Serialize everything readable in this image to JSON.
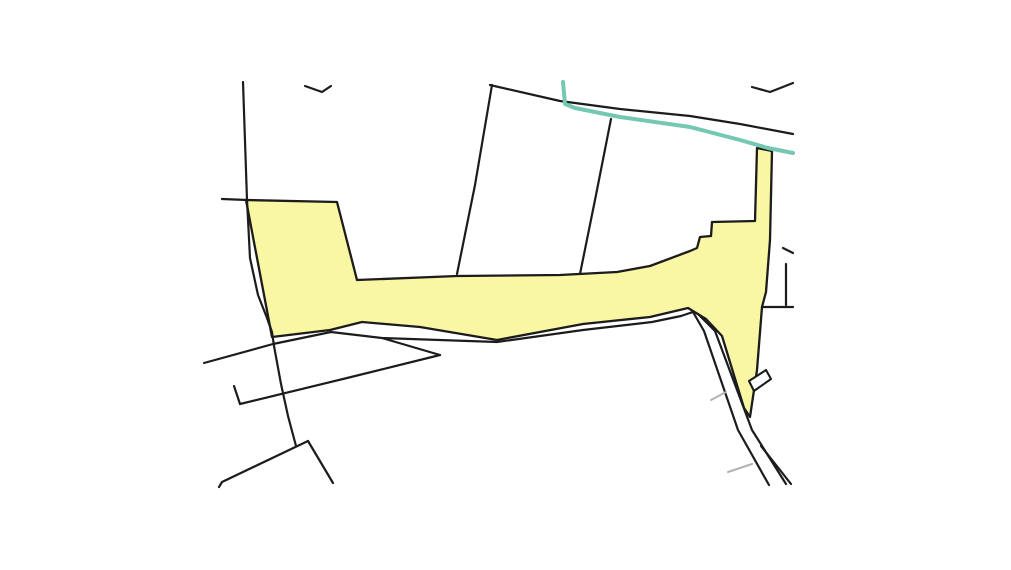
{
  "canvas": {
    "width": 1011,
    "height": 570,
    "background": "#ffffff"
  },
  "map": {
    "colors": {
      "parcel_fill": "#f9f7a3",
      "parcel_stroke": "#1c1c1c",
      "boundary": "#1c1c1c",
      "stream": "#74c8b2",
      "building_fill": "#ffffff",
      "tick": "#b3b3b3"
    },
    "stroke_widths": {
      "boundary": 2.2,
      "parcel": 2.3,
      "stream": 4,
      "building": 2.1,
      "tick": 2
    },
    "highlighted_parcel": {
      "name": "highlighted-parcel",
      "points": [
        [
          246,
          200
        ],
        [
          337,
          202
        ],
        [
          357,
          280
        ],
        [
          457,
          276
        ],
        [
          560,
          275
        ],
        [
          617,
          272
        ],
        [
          650,
          266
        ],
        [
          690,
          251
        ],
        [
          697,
          248
        ],
        [
          700,
          237
        ],
        [
          711,
          236
        ],
        [
          712,
          222
        ],
        [
          755,
          221
        ],
        [
          757,
          148
        ],
        [
          772,
          151
        ],
        [
          770,
          240
        ],
        [
          766,
          292
        ],
        [
          762,
          307
        ],
        [
          757,
          370
        ],
        [
          750,
          417
        ],
        [
          744,
          408
        ],
        [
          722,
          336
        ],
        [
          706,
          319
        ],
        [
          688,
          308
        ],
        [
          650,
          317
        ],
        [
          583,
          324
        ],
        [
          497,
          340
        ],
        [
          420,
          327
        ],
        [
          362,
          322
        ],
        [
          330,
          330
        ],
        [
          272,
          337
        ]
      ]
    },
    "boundaries": [
      {
        "name": "boundary-left-long",
        "points": [
          [
            243,
            82
          ],
          [
            247,
            200
          ],
          [
            250,
            258
          ],
          [
            258,
            295
          ],
          [
            267,
            318
          ],
          [
            272,
            332
          ],
          [
            274,
            346
          ],
          [
            281,
            384
          ],
          [
            288,
            416
          ],
          [
            296,
            446
          ]
        ]
      },
      {
        "name": "boundary-top-stub",
        "points": [
          [
            222,
            199
          ],
          [
            247,
            200
          ]
        ]
      },
      {
        "name": "boundary-check-mark",
        "points": [
          [
            305,
            86
          ],
          [
            322,
            92
          ],
          [
            331,
            86
          ]
        ]
      },
      {
        "name": "boundary-road-north",
        "points": [
          [
            490,
            85
          ],
          [
            560,
            101
          ],
          [
            620,
            109
          ],
          [
            690,
            116
          ],
          [
            740,
            124
          ],
          [
            793,
            134
          ]
        ]
      },
      {
        "name": "boundary-mid-west",
        "points": [
          [
            492,
            85
          ],
          [
            475,
            185
          ],
          [
            457,
            274
          ]
        ]
      },
      {
        "name": "boundary-mid-east",
        "points": [
          [
            611,
            119
          ],
          [
            596,
            195
          ],
          [
            580,
            274
          ]
        ]
      },
      {
        "name": "boundary-top-right-arc",
        "points": [
          [
            752,
            87
          ],
          [
            770,
            92
          ],
          [
            793,
            83
          ]
        ]
      },
      {
        "name": "boundary-south-corridor",
        "points": [
          [
            204,
            363
          ],
          [
            273,
            344
          ],
          [
            331,
            332
          ],
          [
            382,
            338
          ],
          [
            497,
            342
          ],
          [
            583,
            330
          ],
          [
            652,
            322
          ],
          [
            681,
            316
          ],
          [
            693,
            312
          ],
          [
            704,
            331
          ],
          [
            738,
            430
          ],
          [
            769,
            485
          ]
        ]
      },
      {
        "name": "boundary-wedge-upper",
        "points": [
          [
            382,
            338
          ],
          [
            440,
            355
          ]
        ]
      },
      {
        "name": "boundary-wedge-lower",
        "points": [
          [
            440,
            355
          ],
          [
            343,
            379
          ],
          [
            240,
            404
          ]
        ]
      },
      {
        "name": "boundary-wedge-spur",
        "points": [
          [
            234,
            386
          ],
          [
            240,
            404
          ]
        ]
      },
      {
        "name": "boundary-lambda-left",
        "points": [
          [
            308,
            441
          ],
          [
            222,
            482
          ],
          [
            219,
            487
          ]
        ]
      },
      {
        "name": "boundary-lambda-right",
        "points": [
          [
            308,
            441
          ],
          [
            333,
            483
          ]
        ]
      },
      {
        "name": "boundary-track-east",
        "points": [
          [
            698,
            314
          ],
          [
            715,
            331
          ],
          [
            752,
            430
          ],
          [
            786,
            484
          ]
        ]
      },
      {
        "name": "boundary-track-inner",
        "points": [
          [
            761,
            446
          ],
          [
            791,
            484
          ]
        ]
      },
      {
        "name": "boundary-notch-horizontal",
        "points": [
          [
            762,
            307
          ],
          [
            793,
            307
          ]
        ]
      },
      {
        "name": "boundary-notch-stub",
        "points": [
          [
            786,
            264
          ],
          [
            786,
            305
          ]
        ]
      },
      {
        "name": "boundary-edge-fragment",
        "points": [
          [
            783,
            248
          ],
          [
            793,
            253
          ]
        ]
      }
    ],
    "stream": {
      "name": "stream-line",
      "points": [
        [
          563,
          82
        ],
        [
          565,
          104
        ],
        [
          575,
          108
        ],
        [
          620,
          117
        ],
        [
          690,
          127
        ],
        [
          740,
          140
        ],
        [
          768,
          148
        ],
        [
          793,
          153
        ]
      ]
    },
    "building": {
      "name": "building-outline",
      "points": [
        [
          749,
          381
        ],
        [
          766,
          370
        ],
        [
          771,
          379
        ],
        [
          754,
          391
        ]
      ]
    },
    "ticks": [
      {
        "name": "track-tick",
        "points": [
          [
            711,
            400
          ],
          [
            726,
            392
          ]
        ]
      },
      {
        "name": "track-tick",
        "points": [
          [
            728,
            472
          ],
          [
            752,
            464
          ]
        ]
      }
    ]
  }
}
